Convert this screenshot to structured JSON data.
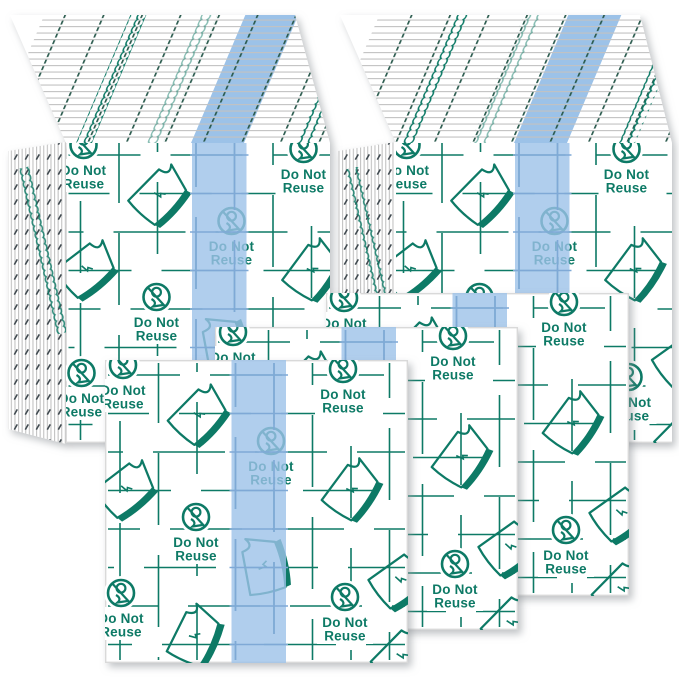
{
  "page": {
    "width": 679,
    "height": 679,
    "background": "#ffffff"
  },
  "labels": {
    "do_not": "Do Not",
    "reuse": "Reuse"
  },
  "colors": {
    "teal": "#0f7a66",
    "stripe_blue": "#9cc2e8",
    "stripe_grid": "#7fa9d6",
    "edge_line": "#c2c2c2",
    "tick": "#2b5a4e",
    "sheet_border": "#d9d9d9",
    "background": "#ffffff"
  },
  "scene": {
    "description": "Transparent grid-printed adhesive film sheets with blue center stripe: two stacked piles behind, three loose square sheets in front",
    "stacks": [
      {
        "name": "back-left-stack"
      },
      {
        "name": "back-right-stack"
      }
    ],
    "loose_sheets": [
      {
        "name": "front-left-sheet"
      },
      {
        "name": "front-middle-sheet"
      },
      {
        "name": "front-right-sheet"
      }
    ],
    "icons": [
      {
        "name": "do-not-reuse-icon",
        "meaning": "crossed single-use symbol in a circle with caption"
      },
      {
        "name": "peel-film-icon",
        "meaning": "tilted film sheet with curled corner"
      }
    ]
  }
}
